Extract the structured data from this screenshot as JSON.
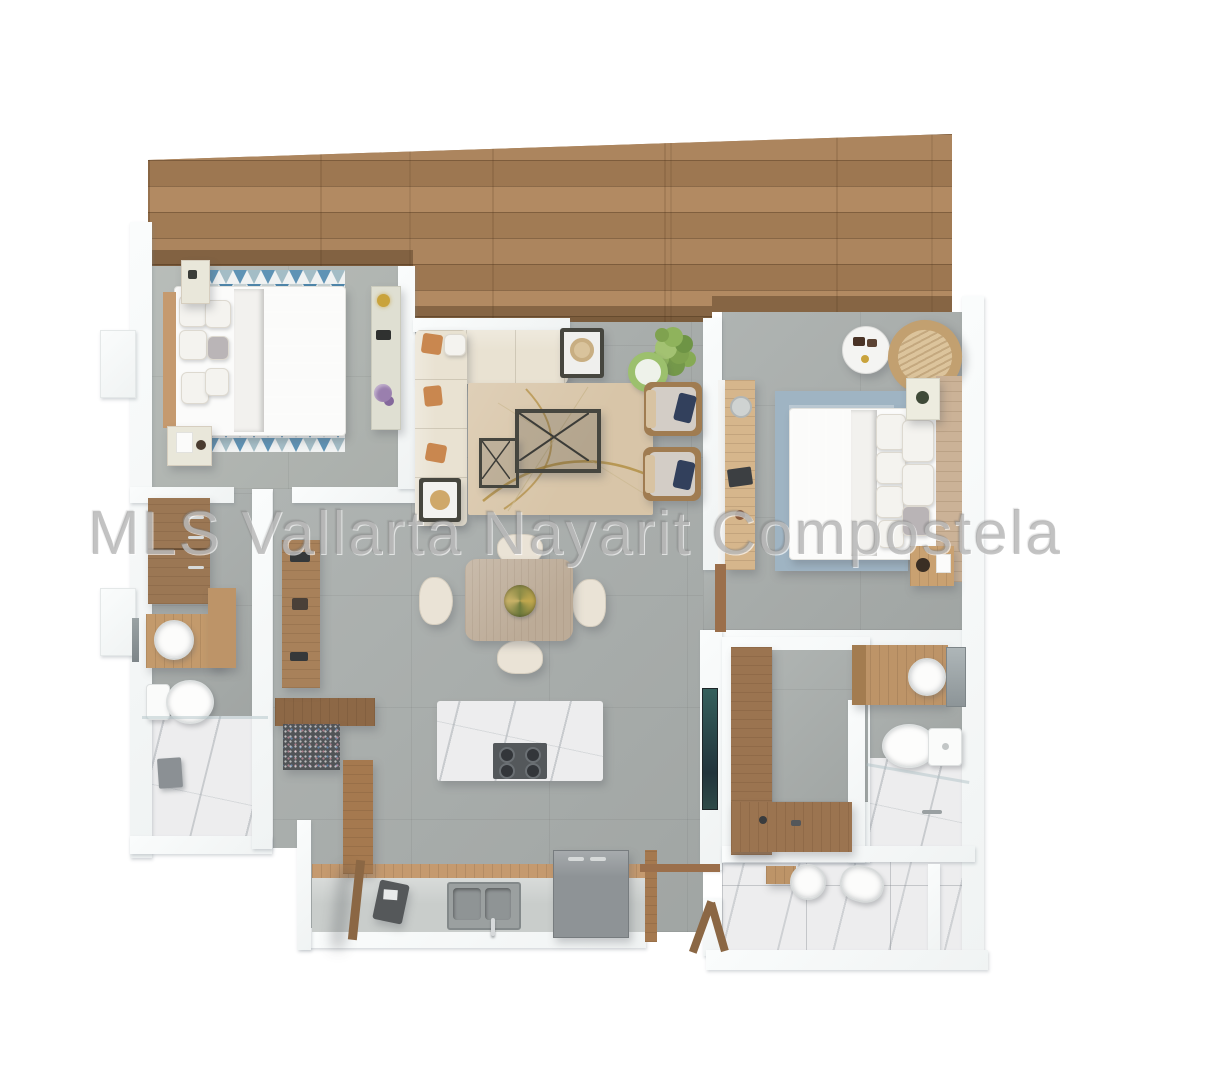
{
  "image": {
    "kind": "3d-floor-plan-top-view-render",
    "width_px": 1223,
    "height_px": 1080
  },
  "watermark": {
    "text": "MLS Vallarta Nayarit Compostela"
  },
  "palette": {
    "wood_deck": "#a5805a",
    "wood_furniture": "#9b7450",
    "wood_light": "#c59a6f",
    "wood_tan": "#cbb297",
    "concrete": "#a9aeac",
    "concrete_light": "#b3b8b4",
    "wall": "#f0f3f3",
    "marble": "#ededee",
    "sofa_cream": "#e9e2d2",
    "chair_cream": "#eae3d6",
    "rug_beige": "#d8c5a8",
    "rug_gold": "#b08c3e",
    "duvet_gray": "#b6b1b3",
    "linen_white": "#f2f1ee",
    "rug1_blue": "#5f93b5",
    "rug2_blue": "#9fb4c3",
    "rug2_inner": "#c5d1d9",
    "navy": "#32405c",
    "orange": "#c9874f",
    "plant_green": "#7fa24f",
    "plant_green_light": "#9cc06d",
    "dark_frame": "#46463f",
    "tv_teal": "#35605c",
    "fridge_gray": "#8e9396",
    "steel_gray": "#9ba0a0",
    "granite": "#515457",
    "gold": "#c9a33c",
    "purple": "#9a7fae"
  },
  "rooms": [
    {
      "name": "terrace-deck",
      "floor": "wood planks"
    },
    {
      "name": "bedroom-1",
      "floor": "concrete",
      "furniture": [
        "double bed",
        "two nightstands",
        "triangle pattern rug",
        "console with gold lamp and flowers"
      ]
    },
    {
      "name": "living-room",
      "floor": "concrete",
      "furniture": [
        "l-shaped cream sofa",
        "beige rug with gold arcs",
        "coffee table",
        "side tables",
        "two armchairs with navy pillows",
        "potted plants"
      ]
    },
    {
      "name": "dining-area",
      "floor": "concrete",
      "furniture": [
        "wood dining table",
        "four cream chairs",
        "green centerpiece"
      ]
    },
    {
      "name": "kitchen",
      "floor": "concrete",
      "furniture": [
        "marble island with cooktop",
        "counter with double sink",
        "refrigerator",
        "wall desk",
        "granite stool",
        "tall cabinet",
        "wood panel",
        "open door"
      ]
    },
    {
      "name": "bathroom-1",
      "floor": "concrete and marble",
      "furniture": [
        "wardrobe",
        "vanity with round sink",
        "toilet",
        "marble shower"
      ]
    },
    {
      "name": "master-bedroom",
      "floor": "concrete",
      "furniture": [
        "double bed",
        "mottled blue rug",
        "wall desk",
        "round side table",
        "wicker lounge chair",
        "two nightstands",
        "wood headboard panel"
      ]
    },
    {
      "name": "walk-in-closet",
      "furniture": [
        "l-shaped wood wardrobe",
        "tv unit"
      ]
    },
    {
      "name": "bathroom-2",
      "floor": "concrete and marble",
      "furniture": [
        "wood vanity with round sink",
        "toilet",
        "marble shower with glass"
      ]
    },
    {
      "name": "laundry",
      "floor": "marble tiles",
      "furniture": [
        "wall shelf",
        "round sink",
        "laundry basin"
      ]
    }
  ]
}
